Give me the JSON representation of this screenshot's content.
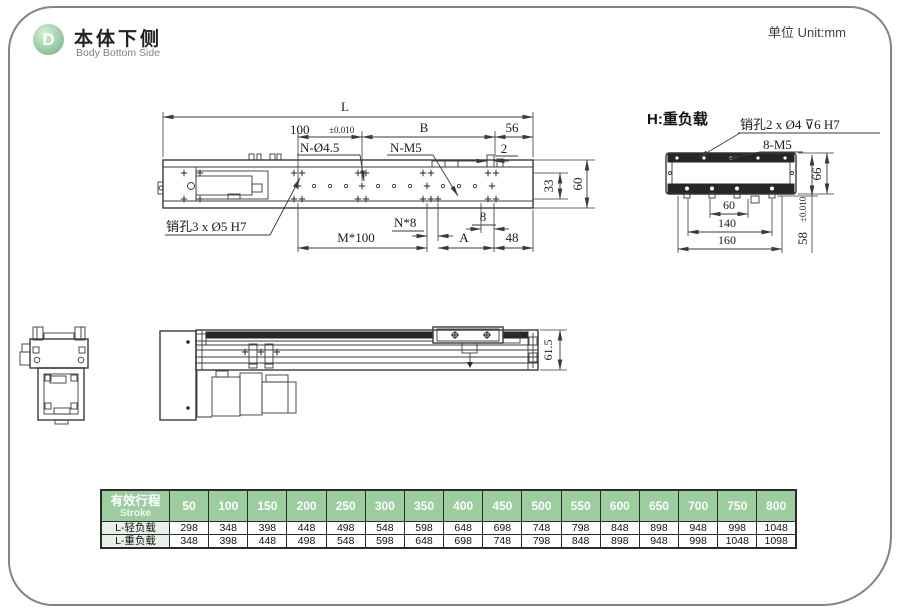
{
  "page": {
    "badge": "D",
    "title_zh": "本体下侧",
    "title_en": "Body Bottom Side",
    "unit": "单位 Unit:mm"
  },
  "colors": {
    "table_header_green": "#9bcd9f",
    "row_label_bg": "#e8eee8",
    "badge_green": "#6fb07e",
    "drawing_line": "#3a3a3a",
    "border_gray": "#7f8781"
  },
  "main_view": {
    "dims": {
      "L": "L",
      "d100": "100",
      "d100_tol": "±0.010",
      "B": "B",
      "d56": "56",
      "d2": "2",
      "d33": "33",
      "d60": "60",
      "n8": "N*8",
      "d8": "8",
      "m100": "M*100",
      "A": "A",
      "d48": "48"
    },
    "labels": {
      "n_holes": "N-Ø4.5",
      "n_m5": "N-M5",
      "pin_holes": "销孔3 x Ø5 H7"
    }
  },
  "heavy_view": {
    "title": "H:重负载",
    "labels": {
      "pin_holes": "销孔2 x Ø4 ⊽6 H7",
      "m5": "8-M5"
    },
    "dims": {
      "d66": "66",
      "d58": "58",
      "d58_tol": "±0.010",
      "d60": "60",
      "d140": "140",
      "d160": "160"
    }
  },
  "side_view": {
    "dims": {
      "d615": "61.5"
    }
  },
  "stroke_table": {
    "header_zh": "有效行程",
    "header_en": "Stroke",
    "columns": [
      "50",
      "100",
      "150",
      "200",
      "250",
      "300",
      "350",
      "400",
      "450",
      "500",
      "550",
      "600",
      "650",
      "700",
      "750",
      "800"
    ],
    "rows": [
      {
        "label": "L-轻负载",
        "values": [
          "298",
          "348",
          "398",
          "448",
          "498",
          "548",
          "598",
          "648",
          "698",
          "748",
          "798",
          "848",
          "898",
          "948",
          "998",
          "1048"
        ]
      },
      {
        "label": "L-重负载",
        "values": [
          "348",
          "398",
          "448",
          "498",
          "548",
          "598",
          "648",
          "698",
          "748",
          "798",
          "848",
          "898",
          "948",
          "998",
          "1048",
          "1098"
        ]
      }
    ]
  }
}
